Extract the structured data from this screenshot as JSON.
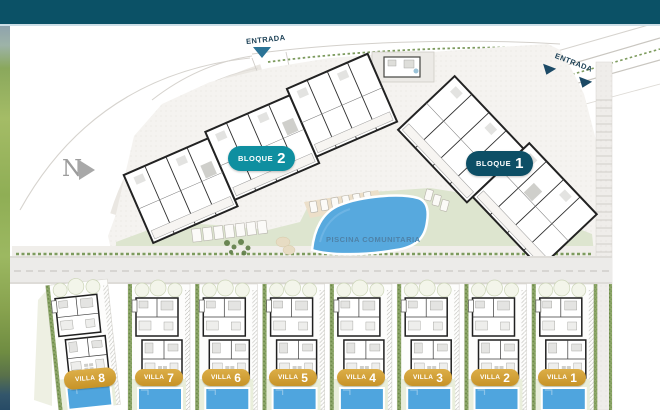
{
  "banner": {
    "color": "#0b5166"
  },
  "north_arrow": {
    "label": "N"
  },
  "entrances": {
    "top": {
      "label": "ENTRADA"
    },
    "right": {
      "label": "ENTRADA"
    }
  },
  "blocks": {
    "bloque2": {
      "name": "BLOQUE",
      "number": "2",
      "badge_color": "#0f8fa0"
    },
    "bloque1": {
      "name": "BLOQUE",
      "number": "1",
      "badge_color": "#0d4f66"
    }
  },
  "pool": {
    "label": "PISCINA COMUNITARIA",
    "water_color": "#57a9de"
  },
  "villas": [
    {
      "name": "VILLA",
      "number": "8"
    },
    {
      "name": "VILLA",
      "number": "7"
    },
    {
      "name": "VILLA",
      "number": "6"
    },
    {
      "name": "VILLA",
      "number": "5"
    },
    {
      "name": "VILLA",
      "number": "4"
    },
    {
      "name": "VILLA",
      "number": "3"
    },
    {
      "name": "VILLA",
      "number": "2"
    },
    {
      "name": "VILLA",
      "number": "1"
    }
  ],
  "villa_badge_color": "#cf9a2c"
}
